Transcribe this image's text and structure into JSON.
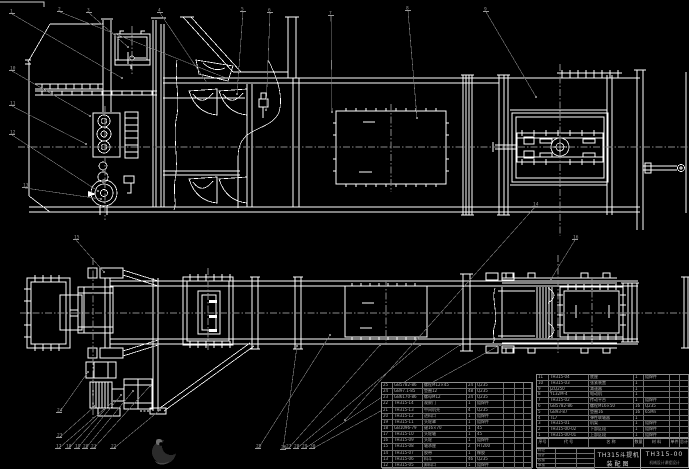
{
  "meta": {
    "background": "#000000",
    "line_color": "#ffffff",
    "leader_color": "#7f7f7f",
    "centerline_color": "#8a8a8a",
    "table_text_color": "#b5b5b5"
  },
  "title_block": {
    "product": "TH315斗提机",
    "sheet_name": "装配图",
    "drawing_no": "TH315-00",
    "org_line": "机械设计课程设计",
    "sign_rows": [
      "标记",
      "设计",
      "校核",
      "审核"
    ]
  },
  "parts_header": [
    "序号",
    "代 号",
    "名 称",
    "数量",
    "材 料",
    "单件",
    "总计",
    "备注"
  ],
  "parts_left": {
    "rows": [
      [
        "25",
        "GB5782-86",
        "螺栓M12×45",
        "24",
        "Q235",
        "",
        "",
        ""
      ],
      [
        "24",
        "GB97.1-85",
        "垫圈12",
        "48",
        "Q235",
        "",
        "",
        ""
      ],
      [
        "23",
        "GB6170-86",
        "螺母M12",
        "24",
        "Q235",
        "",
        "",
        ""
      ],
      [
        "22",
        "TH315-14",
        "观察门",
        "1",
        "组焊件",
        "",
        "",
        ""
      ],
      [
        "21",
        "TH315-13",
        "中间机壳",
        "4",
        "Q235",
        "",
        "",
        ""
      ],
      [
        "20",
        "TH315-12",
        "进料口",
        "1",
        "组焊件",
        "",
        "",
        ""
      ],
      [
        "19",
        "TH315-11",
        "头轮罩",
        "1",
        "组焊件",
        "",
        "",
        ""
      ],
      [
        "18",
        "GB1096-79",
        "键16×70",
        "1",
        "45",
        "",
        "",
        ""
      ],
      [
        "17",
        "TH315-10",
        "头轮轴",
        "1",
        "45",
        "",
        "",
        ""
      ],
      [
        "16",
        "TH315-09",
        "头轮",
        "1",
        "组焊件",
        "",
        "",
        ""
      ],
      [
        "15",
        "TH315-08",
        "轴承座",
        "2",
        "HT200",
        "",
        "",
        ""
      ],
      [
        "14",
        "TH315-07",
        "胶带",
        "1",
        "橡胶",
        "",
        "",
        ""
      ],
      [
        "13",
        "TH315-06",
        "料斗",
        "46",
        "Q235",
        "",
        "",
        ""
      ],
      [
        "12",
        "TH315-05",
        "卸料口",
        "1",
        "组焊件",
        "",
        "",
        ""
      ]
    ]
  },
  "parts_right": {
    "rows": [
      [
        "11",
        "TH315-04",
        "底座",
        "1",
        "组焊件",
        "",
        "",
        ""
      ],
      [
        "10",
        "TH315-03",
        "张紧装置",
        "1",
        "",
        "",
        "",
        ""
      ],
      [
        "9",
        "JZQ250",
        "减速器",
        "1",
        "",
        "",
        "",
        "外购件"
      ],
      [
        "8",
        "Y132M-4",
        "电动机",
        "1",
        "",
        "",
        "",
        "外购件"
      ],
      [
        "7",
        "TH315-02",
        "传动平台",
        "1",
        "组焊件",
        "",
        "",
        ""
      ],
      [
        "6",
        "GB5782-86",
        "螺栓M16×50",
        "16",
        "Q235",
        "",
        "",
        ""
      ],
      [
        "5",
        "GB93-87",
        "垫圈16",
        "16",
        "65Mn",
        "",
        "",
        ""
      ],
      [
        "4",
        "TL7",
        "弹性联轴器",
        "1",
        "",
        "",
        "",
        "外购件"
      ],
      [
        "3",
        "TH315-01",
        "机架",
        "1",
        "组焊件",
        "",
        "",
        ""
      ],
      [
        "2",
        "TH315-00-02",
        "下部区段",
        "1",
        "组焊件",
        "",
        "",
        ""
      ],
      [
        "1",
        "TH315-00-01",
        "上部区段",
        "1",
        "组焊件",
        "",
        "",
        ""
      ]
    ]
  },
  "balloons": [
    [
      "1",
      10,
      11,
      122,
      78
    ],
    [
      "2",
      58,
      9,
      226,
      78
    ],
    [
      "3",
      87,
      10,
      128,
      47
    ],
    [
      "4",
      158,
      10,
      207,
      83
    ],
    [
      "5",
      241,
      9,
      237,
      94
    ],
    [
      "6",
      268,
      10,
      266,
      110
    ],
    [
      "7",
      329,
      13,
      332,
      112
    ],
    [
      "8",
      406,
      8,
      417,
      118
    ],
    [
      "9",
      484,
      9,
      536,
      97
    ],
    [
      "10",
      10,
      68,
      90,
      116
    ],
    [
      "11",
      10,
      103,
      86,
      144
    ],
    [
      "12",
      10,
      132,
      98,
      191
    ],
    [
      "13",
      23,
      185,
      101,
      199
    ],
    [
      "14",
      533,
      204,
      345,
      420
    ],
    [
      "15",
      74,
      237,
      104,
      272
    ],
    [
      "16",
      573,
      237,
      551,
      279
    ],
    [
      "17",
      56,
      446,
      104,
      409
    ],
    [
      "18",
      66,
      446,
      113,
      401
    ],
    [
      "19",
      75,
      446,
      121,
      395
    ],
    [
      "20",
      83,
      446,
      133,
      391
    ],
    [
      "21",
      91,
      446,
      150,
      386
    ],
    [
      "22",
      111,
      446,
      160,
      410
    ],
    [
      "23",
      57,
      435,
      95,
      406
    ],
    [
      "24",
      57,
      410,
      88,
      372
    ],
    [
      "25",
      256,
      446,
      330,
      335
    ],
    [
      "26",
      281,
      447,
      297,
      346
    ],
    [
      "27",
      286,
      446,
      380,
      345
    ],
    [
      "28",
      294,
      446,
      420,
      345
    ],
    [
      "29",
      302,
      446,
      460,
      345
    ],
    [
      "30",
      310,
      446,
      500,
      345
    ]
  ]
}
